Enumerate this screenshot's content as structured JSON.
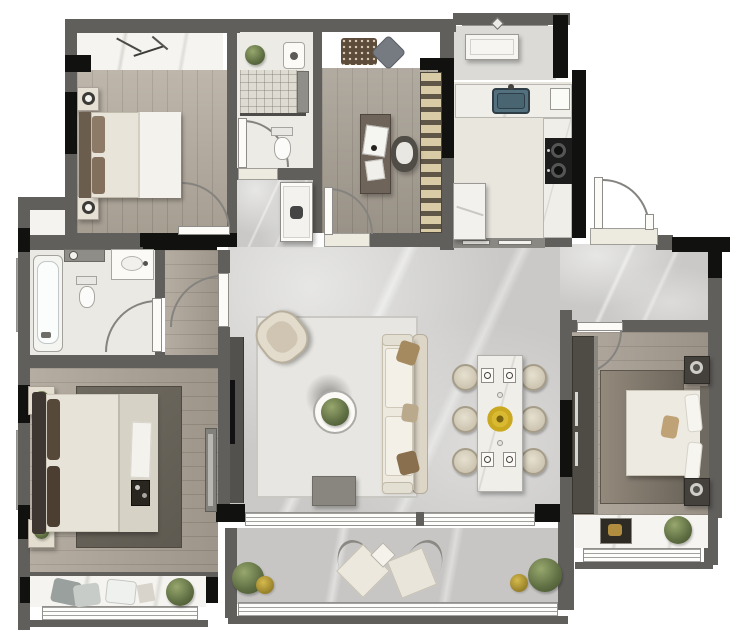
{
  "plan": {
    "title": "Apartment floor plan (rendered top-down, unlabeled)",
    "palette": {
      "wall": "#615f5c",
      "wall_accent": "#111110",
      "wood_floor": "#b3aa9d",
      "marble_floor": "#cac9c7",
      "white_surface": "#f0eee9",
      "sink_blue": "#53707e",
      "plant_green": "#5d6c41",
      "flower_yellow": "#d1b33a",
      "dark_furniture": "#4c4945",
      "sofa_cream": "#eee9df"
    },
    "rooms": [
      {
        "id": "bedroom-northwest",
        "name": "Bedroom (top left)",
        "furniture": [
          "double bed with headboard pillows",
          "two nightstands with round lamps",
          "bay window with marble sill",
          "entry door"
        ]
      },
      {
        "id": "bathroom-north",
        "name": "Bathroom (top center)",
        "furniture": [
          "tiled walk-in shower with glass divider",
          "toilet",
          "washbasin",
          "potted plant",
          "window"
        ]
      },
      {
        "id": "study",
        "name": "Study",
        "furniture": [
          "desk with laptop",
          "desk chair",
          "full-height bookshelf",
          "floor mat and cushion",
          "window"
        ]
      },
      {
        "id": "kitchen",
        "name": "Kitchen",
        "furniture": [
          "counter with blue sink",
          "two-burner cooktop",
          "refrigerator",
          "sliding door to hall"
        ]
      },
      {
        "id": "service-balcony",
        "name": "Service balcony (top right)",
        "furniture": [
          "appliance unit",
          "window band"
        ]
      },
      {
        "id": "entry",
        "name": "Entry",
        "furniture": [
          "double entrance door with swing arc",
          "marble threshold"
        ]
      },
      {
        "id": "living-room",
        "name": "Living room",
        "furniture": [
          "three-seat sofa with pillows",
          "rounded armchair",
          "round coffee table with plant",
          "TV cabinet on west wall",
          "large area rug",
          "low media bench"
        ]
      },
      {
        "id": "dining-area",
        "name": "Dining area",
        "furniture": [
          "rectangular marble dining table",
          "six round-back chairs",
          "yellow flower centerpiece",
          "four place settings"
        ]
      },
      {
        "id": "corridor",
        "name": "Corridor to master suite",
        "furniture": [
          "swing door from living room",
          "hall vanity with basin"
        ]
      },
      {
        "id": "bathroom-west",
        "name": "Bathroom (left wing)",
        "furniture": [
          "bathtub",
          "toilet",
          "vanity washbasin",
          "counter",
          "window"
        ]
      },
      {
        "id": "master-bedroom",
        "name": "Master bedroom (bottom left)",
        "furniture": [
          "king bed with dark headboard",
          "two nightstands with plants",
          "dark area rug",
          "breakfast tray on bed",
          "dresser",
          "bay window seat with cushions and plant"
        ]
      },
      {
        "id": "bedroom-east",
        "name": "Bedroom (right)",
        "furniture": [
          "double bed with headboard on east wall",
          "two dark nightstands with lamps",
          "wardrobe",
          "area rug",
          "bay window shelf with framed picture and plant"
        ]
      },
      {
        "id": "south-balcony",
        "name": "Balcony (bottom)",
        "furniture": [
          "two lounge cushions",
          "small diamond side table",
          "potted plants both ends",
          "full-width window rail"
        ]
      }
    ]
  }
}
